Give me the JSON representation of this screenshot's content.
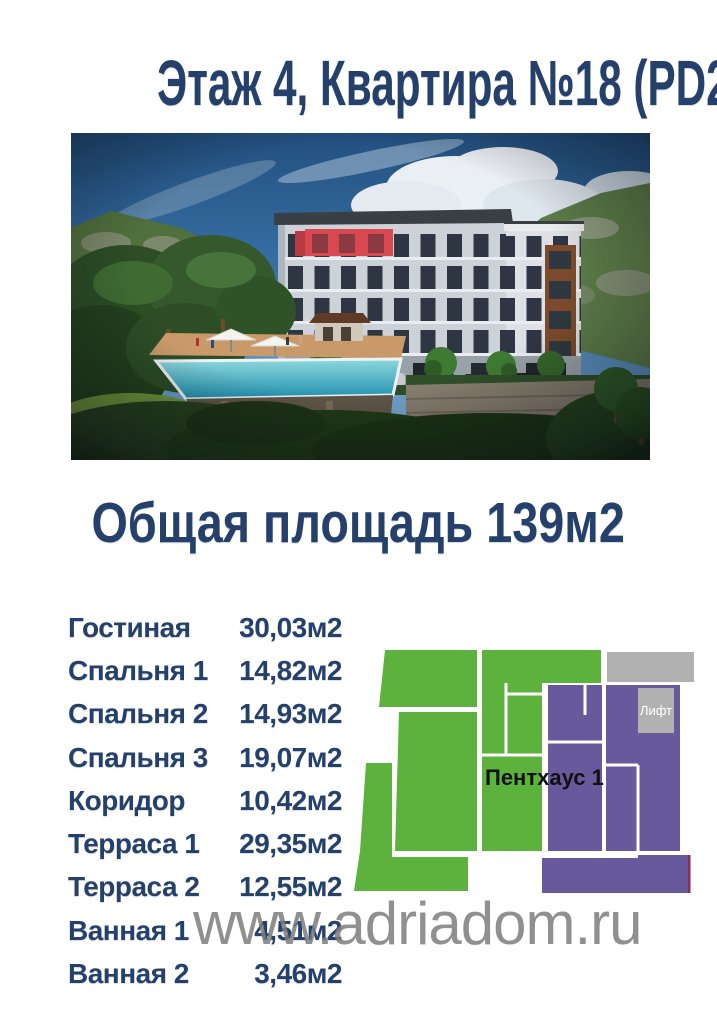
{
  "page": {
    "title": "Этаж 4, Квартира №18 (PD28)",
    "area_heading": "Общая площадь 139м2",
    "watermark": "www.adriadom.ru"
  },
  "rooms": [
    {
      "label": "Гостиная",
      "area": "30,03м2"
    },
    {
      "label": "Спальня 1",
      "area": "14,82м2"
    },
    {
      "label": "Спальня 2",
      "area": "14,93м2"
    },
    {
      "label": "Спальня 3",
      "area": "19,07м2"
    },
    {
      "label": "Коридор",
      "area": "10,42м2"
    },
    {
      "label": "Терраса 1",
      "area": "29,35м2"
    },
    {
      "label": "Терраса 2",
      "area": "12,55м2"
    },
    {
      "label": "Ванная 1",
      "area": "4,51м2"
    },
    {
      "label": "Ванная 2",
      "area": "3,46м2"
    }
  ],
  "floor_plan": {
    "penthouse_label": "Пентхаус 1",
    "elevator_label": "Лифт"
  },
  "palette": {
    "heading_navy": "#24406b",
    "watermark_gray": "#7d7d7d",
    "plan_green": "#5cb23c",
    "plan_purple": "#67599b",
    "plan_gray": "#b1b1b1",
    "highlight_red": "#d9484f"
  }
}
